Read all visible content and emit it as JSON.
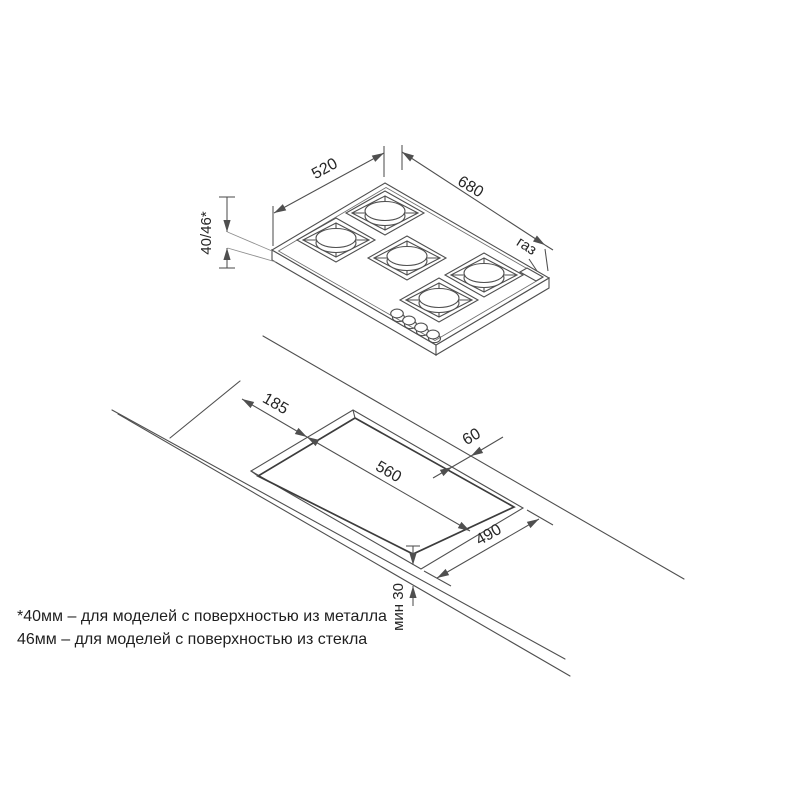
{
  "hob_view": {
    "dim_depth": "520",
    "dim_width": "680",
    "dim_height": "40/46*",
    "gas_label": "газ"
  },
  "cutout_view": {
    "dim_offset_left": "185",
    "dim_back_gap": "60",
    "dim_width": "560",
    "dim_depth": "490",
    "dim_front_min": "мин 30"
  },
  "footnote": {
    "line1": "*40мм – для моделей с поверхностью из металла",
    "line2": "46мм – для моделей с поверхностью из стекла"
  },
  "colors": {
    "line": "#4f4f4f",
    "light_line": "#8f8f8f",
    "dark_line": "#3c3c3c",
    "text": "#262626",
    "background": "#ffffff"
  }
}
